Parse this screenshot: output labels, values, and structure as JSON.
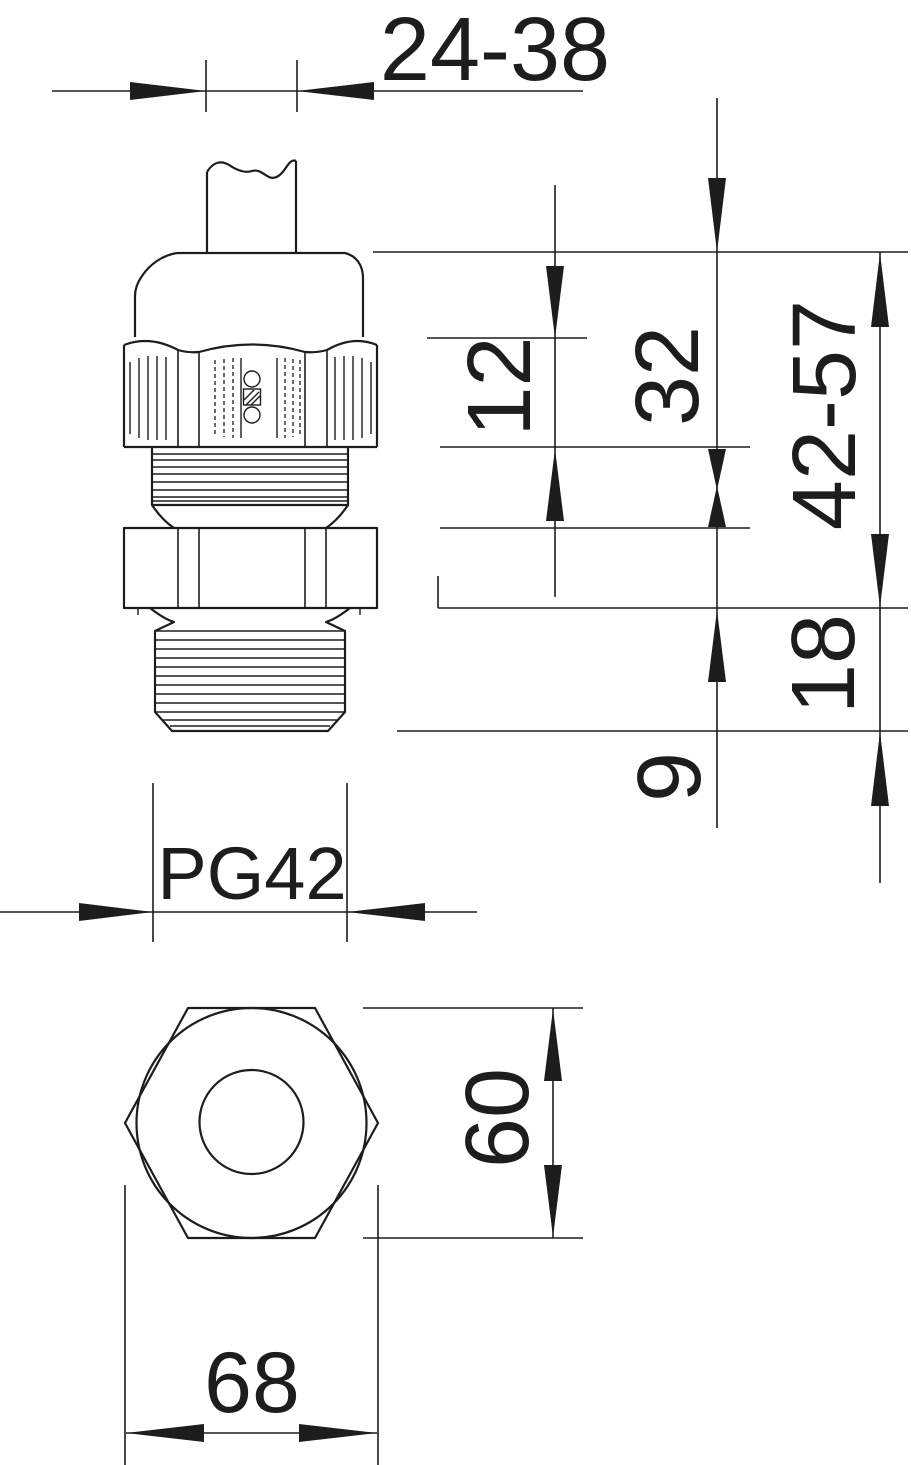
{
  "meta": {
    "background": "#ffffff",
    "ink": "#1d1d1b",
    "drawing_type": "cable gland dimension drawing"
  },
  "dimensions": {
    "clamping_range": "24-38",
    "nut_height": "12",
    "upper_height": "32",
    "overall_height": "42-57",
    "thread_length": "18",
    "lower_offset": "9",
    "thread_size": "PG42",
    "across_flats": "60",
    "across_corners": "68"
  },
  "brand": "OBO"
}
